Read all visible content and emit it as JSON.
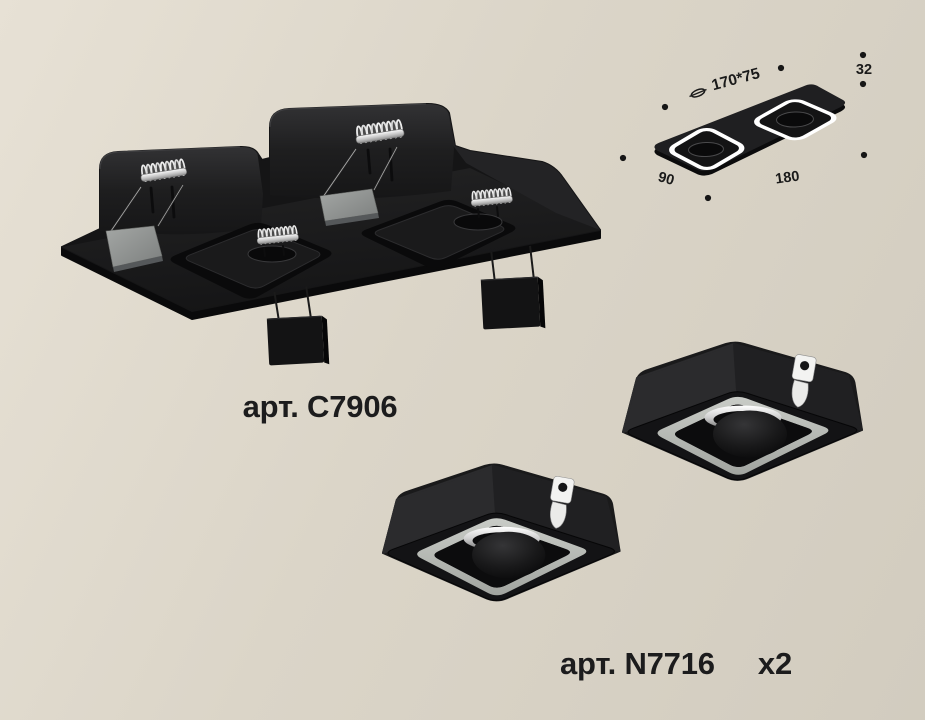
{
  "page": {
    "background_top": "#e7e1d5",
    "background_bottom": "#d2ccbf"
  },
  "products": {
    "frame": {
      "article_label": "арт. C7906"
    },
    "module": {
      "article_label": "арт. N7716",
      "quantity_label": "x2"
    }
  },
  "dimension_diagram": {
    "cutout_label": "170*75",
    "height_label": "32",
    "width_label": "90",
    "length_label": "180"
  },
  "colors": {
    "text": "#1c1c1d",
    "fixture_black": "#1a1a1b",
    "spring_silver": "#e9e9e9",
    "bracket_gray": "#8f9290",
    "module_ring_gray": "#b4b7b2",
    "diagram_ring_white": "#ffffff"
  }
}
